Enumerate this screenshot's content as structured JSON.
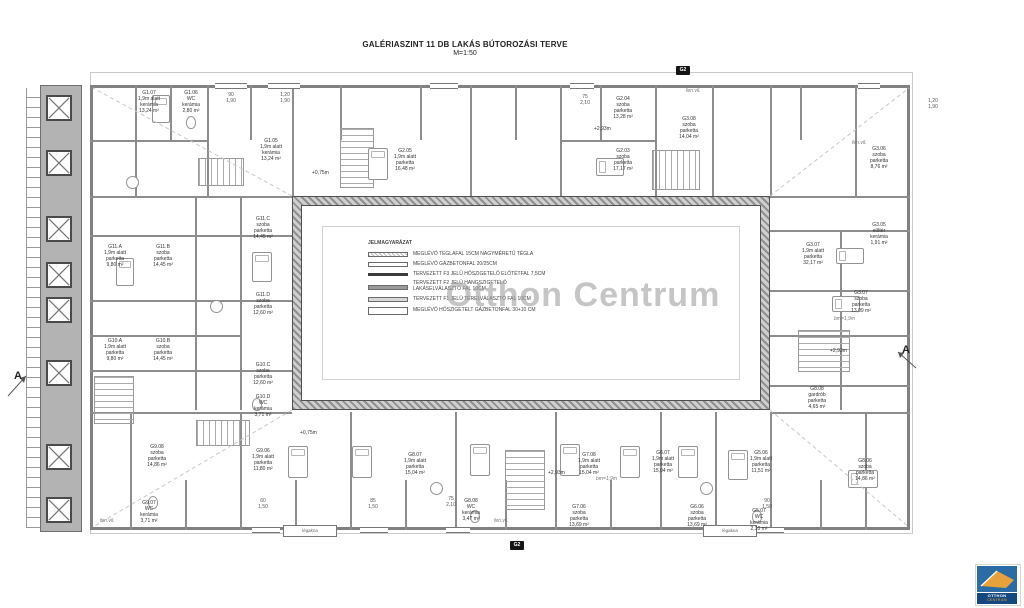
{
  "title": {
    "line1": "GALÉRIASZINT 11 DB LAKÁS BÚTOROZÁSI TERVE",
    "line2": "M=1:50"
  },
  "watermark": "Otthon Centrum",
  "legend": {
    "title": "JELMAGYARÁZAT",
    "items": [
      "MEGLÉVŐ TÉGLAFAL 15CM NAGYMÉRETŰ TÉGLA",
      "MEGLÉVŐ GÁZBETONFAL 20/25CM",
      "TERVEZETT F3 JELŰ HŐSZIGETELŐ ELŐTÉTFAL 7,5CM",
      "TERVEZETT F2 JELŰ HANGSZIGETELŐ\nLAKÁSELVÁLASZTÓ FAL 10CM",
      "TERVEZETT F1 JELŰ TÉRELVÁLASZTÓ FAL 10CM",
      "MEGLÉVŐ HŐSZIGETELT GÁZBETONFAL 30+10 CM"
    ]
  },
  "markers": {
    "left": "A",
    "right": "A",
    "top": "G2",
    "bottom": "G2"
  },
  "rooms": [
    "G1.07\n1,9m alatt\nkerámia\n13,24 m²",
    "G1.06\nWC\nkerámia\n2,80 m²",
    "G1.05\n1,9m alatt\nkerámia\n13,24 m²",
    "G2.05\n1,9m alatt\nparketta\n16,48 m²",
    "G2.04\nszoba\nparketta\n13,28 m²",
    "G2.03\nszoba\nparketta\n17,17 m²",
    "G3.08\nszoba\nparketta\n14,04 m²",
    "G3.06\nszoba\nparketta\n8,76 m²",
    "G3.05\nelőtér\nkerámia\n1,91 m²",
    "G3.07\n1,9m alatt\nparketta\n32,17 m²",
    "G3.07\nszoba\nparketta\n13,09 m²",
    "G11.A\n1,9m alatt\nparketta\n9,80 m²",
    "G11.B\nszoba\nparketta\n14,45 m²",
    "G11.C\nszoba\nparketta\n14,45 m²",
    "G11.D\nszoba\nparketta\n12,60 m²",
    "G10.A\n1,9m alatt\nparketta\n9,80 m²",
    "G10.B\nszoba\nparketta\n14,45 m²",
    "G10.C\nszoba\nparketta\n12,60 m²",
    "G10.D\nWC\nkerámia\n3,71 m²",
    "G9.08\nszoba\nparketta\n14,86 m²",
    "G9.06\n1,9m alatt\nparketta\n11,80 m²",
    "G9.07\nWC\nkerámia\n3,71 m²",
    "G8.07\n1,9m alatt\nparketta\n15,04 m²",
    "G8.08\nWC\nkerámia\n3,47 m²",
    "G7.08\n1,9m alatt\nparketta\n15,04 m²",
    "G7.06\nszoba\nparketta\n13,69 m²",
    "G6.07\n1,9m alatt\nparketta\n15,04 m²",
    "G6.06\nszoba\nparketta\n13,69 m²",
    "G5.06\n1,9m alatt\nparketta\n11,51 m²",
    "G5.07\nWC\nkerámia\n2,10 m²",
    "G8.06\nszoba\nparketta\n14,86 m²",
    "G8.08\ngardrób\nparketta\n4,65 m²"
  ],
  "dims": [
    "90\n1,90",
    "1,20\n1,90",
    "75\n2,10",
    "1,20\n1,90",
    "60\n1,50",
    "85\n1,50",
    "75\n2,10",
    "90\n1,50"
  ],
  "levels": [
    "+2,93m",
    "+2,93m",
    "+2,93m",
    "+0,75m",
    "+0,75m"
  ],
  "notes": {
    "fen_vil": "fen.vil.",
    "legakna": "légakna",
    "bm": "bm=1,9m"
  },
  "logo": {
    "line1": "OTTHON",
    "line2": "CENTRUM"
  },
  "colors": {
    "logo_blue": "#15487e",
    "logo_sky": "#2a6ca3",
    "logo_orange": "#e8a23c",
    "wall_gray": "#8d8d8d",
    "watermark_gray": "#9f9f9f"
  },
  "icons": {
    "skylight": "x-cross square",
    "bed": "rounded rectangle with pillow",
    "toilet": "ellipse",
    "table": "circle",
    "stairs": "striped run"
  }
}
